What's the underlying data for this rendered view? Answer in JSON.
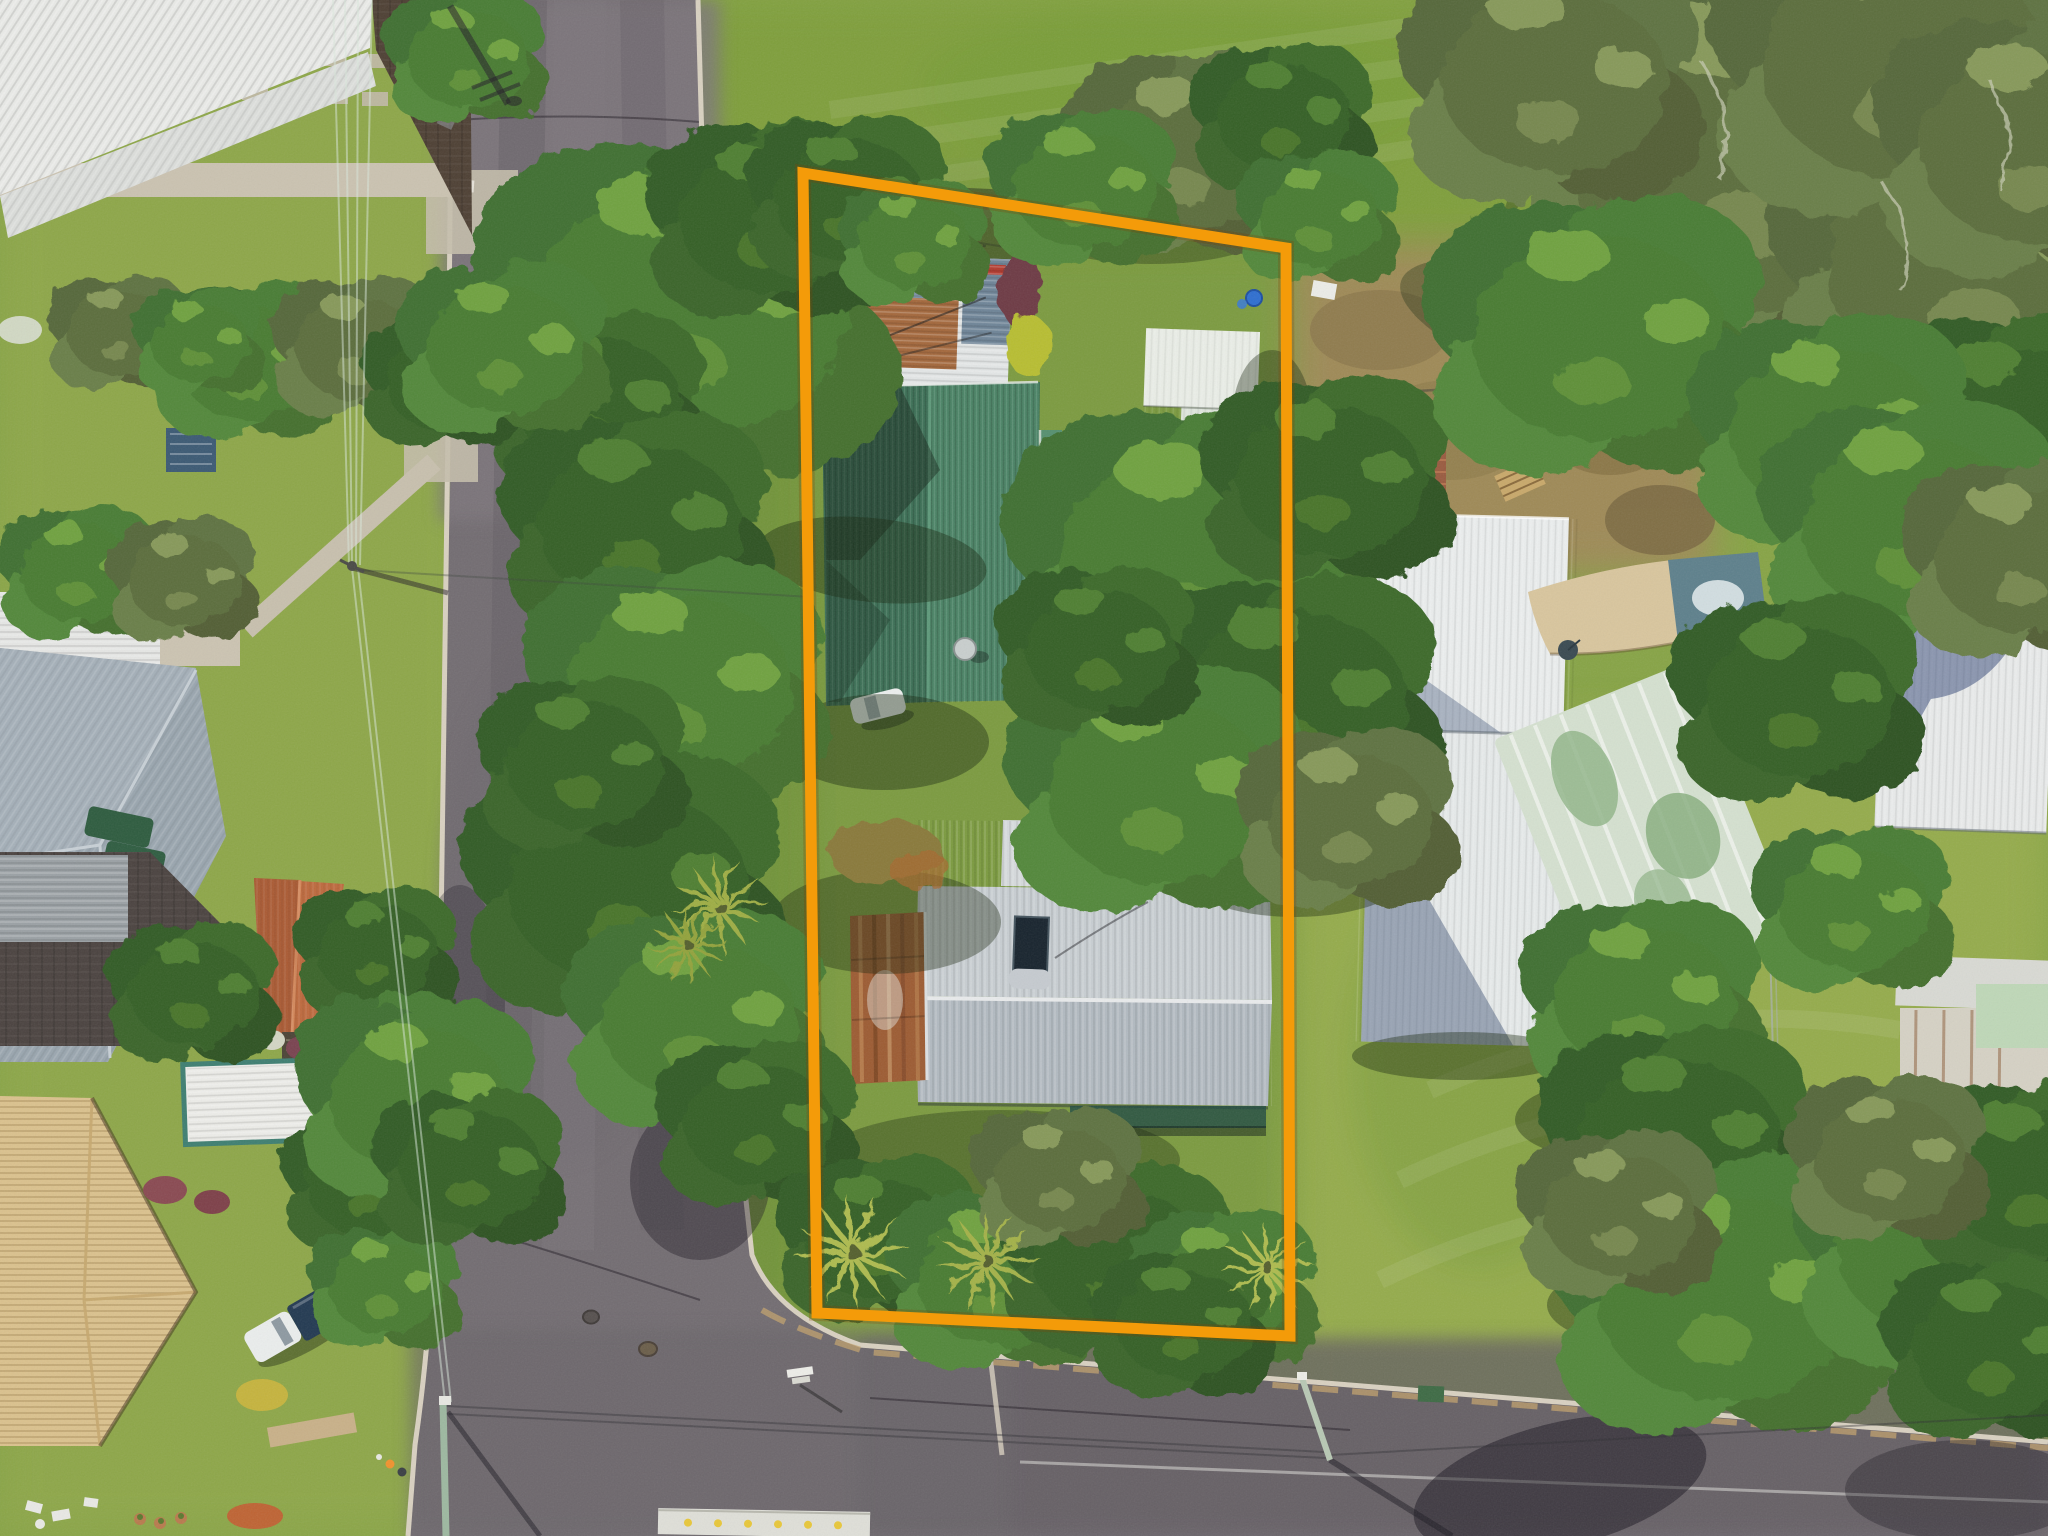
{
  "scene": {
    "type": "aerial-photograph",
    "title": "Top-down drone photo of a residential corner block outlined in orange",
    "view": "top-down",
    "setting": "suburban coastal neighbourhood, T-intersection at the south-west corner of the lot"
  },
  "boundary": {
    "label": "property-boundary-outline",
    "color": "#F49B09",
    "underglow": "rgba(130,65,0,0.25)",
    "stroke_width": 11,
    "points": "803,173 1286,248 1290,1336 817,1313"
  },
  "subject_lot": {
    "structures": [
      {
        "name": "patchwork-carport",
        "roof_colors": [
          "#E3E6E6",
          "#7E93A6",
          "#A4683C"
        ],
        "detail": "white, slate-blue and rusty corrugated panels"
      },
      {
        "name": "green-roof-house",
        "roof_color": "#4A8365",
        "roof_color_dark": "#3C7056",
        "features": [
          "satellite-dish",
          "white-car-parked-east-side"
        ]
      },
      {
        "name": "grey-roof-house",
        "roof_color": "#C8CED2",
        "roof_color_lower": "#B2BAC1",
        "features": [
          "solar-hot-water-panel",
          "satellite-dish",
          "round-fire-pit",
          "rusty-carport",
          "dark-veranda"
        ]
      },
      {
        "name": "garden-shed",
        "roof_color": "#EAEEE7"
      }
    ],
    "garden": [
      "palm-trees",
      "dense-shrub-border-south",
      "shade-trees-west",
      "lawn",
      "blue-barrel",
      "metal-fence-panels-south"
    ]
  },
  "streets": {
    "west_street": {
      "orientation": "north-south",
      "color": "#7A747A",
      "features": [
        "pole-shadow-north",
        "tyre-wear-lanes",
        "driveway-crossovers"
      ]
    },
    "south_street": {
      "orientation": "east-west",
      "color": "#645E64",
      "features": [
        "manhole-covers",
        "worn-white-line",
        "sandy-gutter",
        "tree-shadow"
      ]
    },
    "junction": "T-intersection with rounded grass corner at the lot's south-west"
  },
  "neighbors": {
    "west": [
      "white-roof-house-north",
      "slate-roof-house-green-awnings",
      "charcoal-roof-house-terracotta-gable",
      "white-carport-teal-trim",
      "cream-tile-roof-house",
      "pickup-truck-navy-canopy"
    ],
    "east": [
      "dirt-yard-with-pallet-and-swing",
      "white-roof-shed",
      "faded-green-roof-house",
      "tan-shade-sail",
      "teal-roof-panel",
      "white-roof-house-under-tree-shadow",
      "weathered-roof-house-mint-section"
    ],
    "north": "open mown lawn with eucalyptus stand",
    "south": "open lawn, fence-line trees, street-light pole"
  },
  "utilities": {
    "power_lines": "pale wires along west verge converging at poles, service wires across the intersection",
    "street_light_sw": "green pole with long shadow",
    "street_light_se": "leaning pale pole with long shadow",
    "street_sign": "white blade sign near corner",
    "manholes": 2,
    "people": [
      "hi-vis-worker",
      "pedestrian"
    ]
  },
  "palette": {
    "lawn": "#87A446",
    "lawn_bright": "#97AD4D",
    "lawn_top": "#7E9E3A",
    "lawn_lot": "#7A9A40",
    "lawn_shade": "rgba(25,40,16,0.42)",
    "asphalt": "#736D72",
    "asphalt_light": "#7D777C",
    "asphalt_dark": "#645E64",
    "concrete": "#CBC3B1",
    "kerb": "#D9D1C1",
    "dirt": "#A0895A",
    "tree_dark": "#335C26",
    "tree_mid": "#3F7030",
    "tree_olive": "#57683B",
    "palm": "#AEBB4F",
    "terracotta": "#BE6A3E",
    "cream_roof": "#DBC28E",
    "rust": "#9D5C33",
    "shade_sail": "#D9C69E"
  }
}
